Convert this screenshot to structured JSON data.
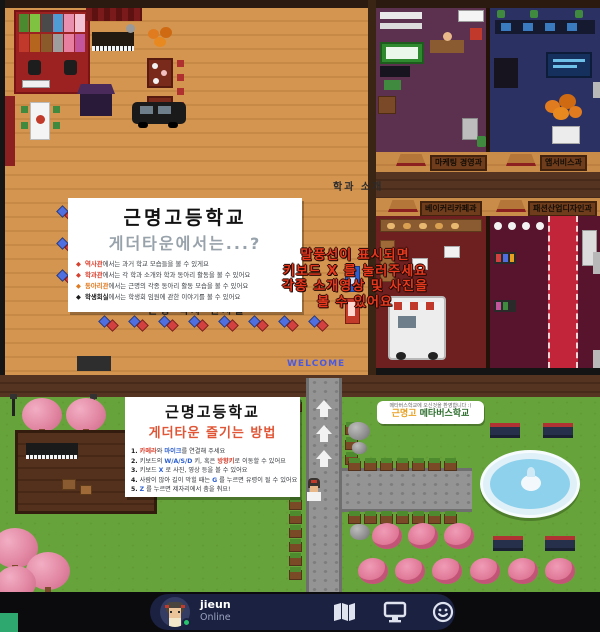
{
  "map": {
    "history_room_text": "근명 역사 전시실",
    "welcome_text": "WELCOME",
    "corridor_sign": "학과 소개",
    "dept_signs": {
      "marketing": "마케팅 경영과",
      "webservice": "앱서비스과",
      "bakery": "베이커리카페과",
      "fashion": "패션산업디자인과"
    }
  },
  "info_box_top": {
    "title": "근명고등학교",
    "subtitle": "게더타운에서는...?",
    "bullets": [
      {
        "marker": "◆",
        "keyword": "역사관",
        "text": "에서는 과거 학교 모습들을 볼 수 있게요"
      },
      {
        "marker": "◆",
        "keyword": "학과관",
        "text": "에서는 각 학과 소개와 학과 동아리 활동을 볼 수 있어요"
      },
      {
        "marker": "◆",
        "keyword": "동아리관",
        "text": "에서는 근명의 각종 동아리 활동 모습을 볼 수 있어요"
      },
      {
        "marker": "◆",
        "keyword": "학생회실",
        "text": "에서는 학생회 임원에 관한 이야기를 볼 수 있어요"
      }
    ]
  },
  "keyboard_tip": {
    "line1": "말풍선이 표시되면",
    "line2": "키보드 X 를 눌러주세요",
    "line3": "각종 소개영상 및 사진을",
    "line4": "볼 수 있어요"
  },
  "info_box_bottom": {
    "title": "근명고등학교",
    "subtitle": "게더타운 즐기는 방법",
    "steps": [
      {
        "n": "1.",
        "s0": " ",
        "k1": "카메라",
        "s1": "와 ",
        "k2": "마이크",
        "s2": "를 연결해 주세요"
      },
      {
        "n": "2.",
        "s0": " 키보드의 ",
        "k1": "W/A/S/D",
        "s1": " 키, 혹은 ",
        "k2": "방향키",
        "s2": "로 이동할 수 있어요"
      },
      {
        "n": "3.",
        "s0": " 키보드 ",
        "k1": "X",
        "s1": " 로 사진, 영상 등을 볼 수 있어요",
        "k2": "",
        "s2": ""
      },
      {
        "n": "4.",
        "s0": " 사람이 많아 길이 막힐 때는 ",
        "k1": "G",
        "s1": " 를 누르면 유령이 될 수 있어요",
        "k2": "",
        "s2": ""
      },
      {
        "n": "5.",
        "s0": " ",
        "k1": "Z",
        "s1": " 를 누르면 제자리에서 춤을 춰요!",
        "k2": "",
        "s2": ""
      }
    ]
  },
  "banner": {
    "small_text": "메타버스학교에 오신것을 환영합니다 :)",
    "name_accent": "근명고",
    "name_rest": " 메타버스학교"
  },
  "bottom_bar": {
    "user_name": "jieun",
    "status": "Online",
    "icons": [
      {
        "name": "map-icon"
      },
      {
        "name": "screen-share-icon"
      },
      {
        "name": "emote-icon"
      }
    ]
  },
  "colors": {
    "status_online": "#27c46d",
    "tip_red": "#e8391f",
    "subtitle_red": "#e05535",
    "banner_accent": "#e8a020",
    "banner_green": "#2d6e2d"
  }
}
